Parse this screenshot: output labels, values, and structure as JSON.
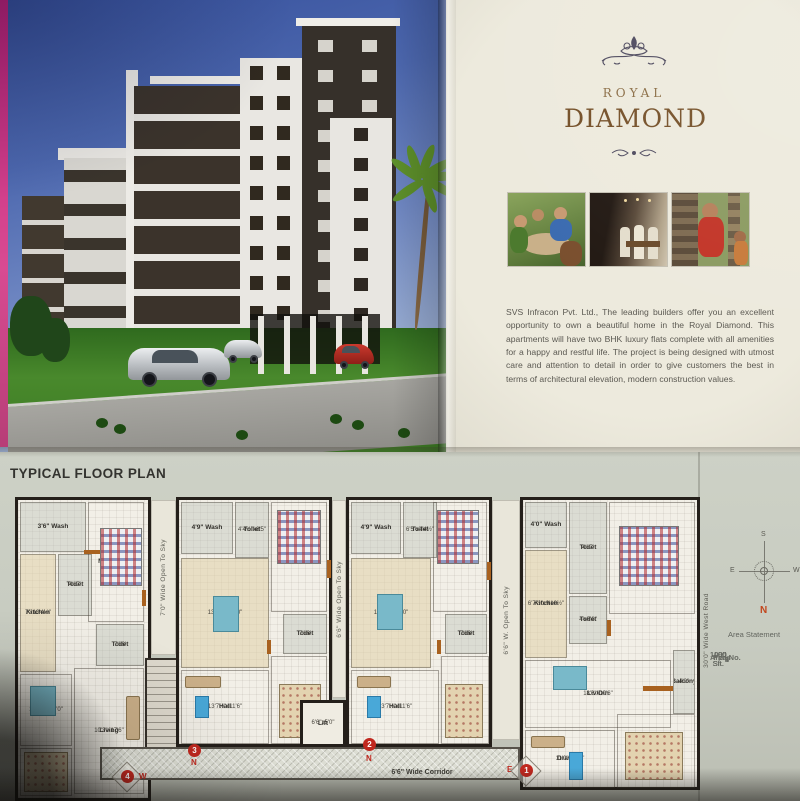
{
  "brand": {
    "royal": "ROYAL",
    "diamond": "DIAMOND"
  },
  "intro": {
    "text": "SVS Infracon Pvt. Ltd., The leading builders offer you an excellent opportunity to own a beautiful home in the Royal Diamond. This apartments will have two BHK luxury flats complete with all amenities for a happy and restful life. The project is being designed with utmost care and attention to detail in order to give customers the best in terms of architectural elevation, modern construction values."
  },
  "floor_plan": {
    "title": "TYPICAL FLOOR PLAN",
    "open_to_sky": [
      "7'0\" Wide Open To Sky",
      "6'6\" Wide Open To Sky",
      "6'6\" W. Open To Sky"
    ],
    "road_label": "30'0\" Wide West Road",
    "corridor_label": "6'6\" Wide Corridor",
    "lift": {
      "name": "Lift",
      "dim": "6'6\"x5'0\""
    },
    "markers": [
      {
        "no": "4",
        "dir": "W"
      },
      {
        "no": "3",
        "dir": "N"
      },
      {
        "no": "2",
        "dir": "N"
      },
      {
        "no": "1",
        "dir": "E"
      }
    ],
    "flats": [
      {
        "rooms": [
          {
            "name": "3'6\" Wash"
          },
          {
            "name": "Toilet",
            "dim": "4'x7'"
          },
          {
            "name": "Kitchen",
            "dim": "7'x10'4½\""
          },
          {
            "name": "M.Bedroom",
            "dim": "10'3\"x13'6\""
          },
          {
            "name": "Toilet",
            "dim": "7'x6'"
          },
          {
            "name": "Dining",
            "dim": "11'4½\"x11'0\""
          },
          {
            "name": "Living",
            "dim": "10'3\"x17'6\""
          },
          {
            "name": "Bedroom",
            "dim": "11'4½\"x10'8\""
          }
        ]
      },
      {
        "rooms": [
          {
            "name": "4'9\" Wash"
          },
          {
            "name": "Toilet",
            "dim": "4'4½\"x6'5\""
          },
          {
            "name": "M.Bedroom",
            "dim": "10'6\"x13'0\""
          },
          {
            "name": "Kit/Din",
            "dim": "13'7½\"x13'0\""
          },
          {
            "name": "Toilet",
            "dim": "7'x6'"
          },
          {
            "name": "Hall",
            "dim": "13'7½\"x11'6\""
          },
          {
            "name": "Bedroom",
            "dim": "10'6\"x11'6\""
          }
        ]
      },
      {
        "rooms": [
          {
            "name": "4'9\" Wash"
          },
          {
            "name": "Toilet",
            "dim": "6'5\"x4'4½\""
          },
          {
            "name": "M.Bedroom",
            "dim": "10'6\"x13'0\""
          },
          {
            "name": "Kit/Din",
            "dim": "13'7½\"x13'0\""
          },
          {
            "name": "Toilet",
            "dim": "7'x6'"
          },
          {
            "name": "Hall",
            "dim": "13'7½\"x11'6\""
          },
          {
            "name": "Bedroom",
            "dim": "10'6\"x11'6\""
          }
        ]
      },
      {
        "rooms": [
          {
            "name": "4'0\" Wash"
          },
          {
            "name": "Toilet",
            "dim": "4'x7'"
          },
          {
            "name": "M.Bedroom",
            "dim": "10'9\"x13'6\""
          },
          {
            "name": "Kitchen",
            "dim": "6'7½\"x9'10½\""
          },
          {
            "name": "Toilet",
            "dim": "4'x6'6\""
          },
          {
            "name": "Liv/Din",
            "dim": "18'6\"x10'6\""
          },
          {
            "name": "Balcony",
            "dim": "4'0\""
          },
          {
            "name": "Drawing",
            "dim": "11'0\"x11'0\""
          },
          {
            "name": "Bedroom",
            "dim": "10'9\"x11'"
          }
        ]
      }
    ]
  },
  "compass": {
    "n": "N",
    "s": "S",
    "e": "E",
    "w": "W"
  },
  "area_statement": {
    "title": "Area Statement",
    "headers": [
      "Flat No.",
      "Areas"
    ],
    "rows": [
      [
        "1",
        "1100 Sft."
      ],
      [
        "2",
        "1000 Sft."
      ],
      [
        "3",
        "1000 Sft."
      ],
      [
        "4",
        "1095 Sft."
      ]
    ]
  },
  "accent_colors": {
    "marker_red": "#c0281f",
    "brand_gold": "#744f27",
    "plan_wall": "#241f1a"
  }
}
